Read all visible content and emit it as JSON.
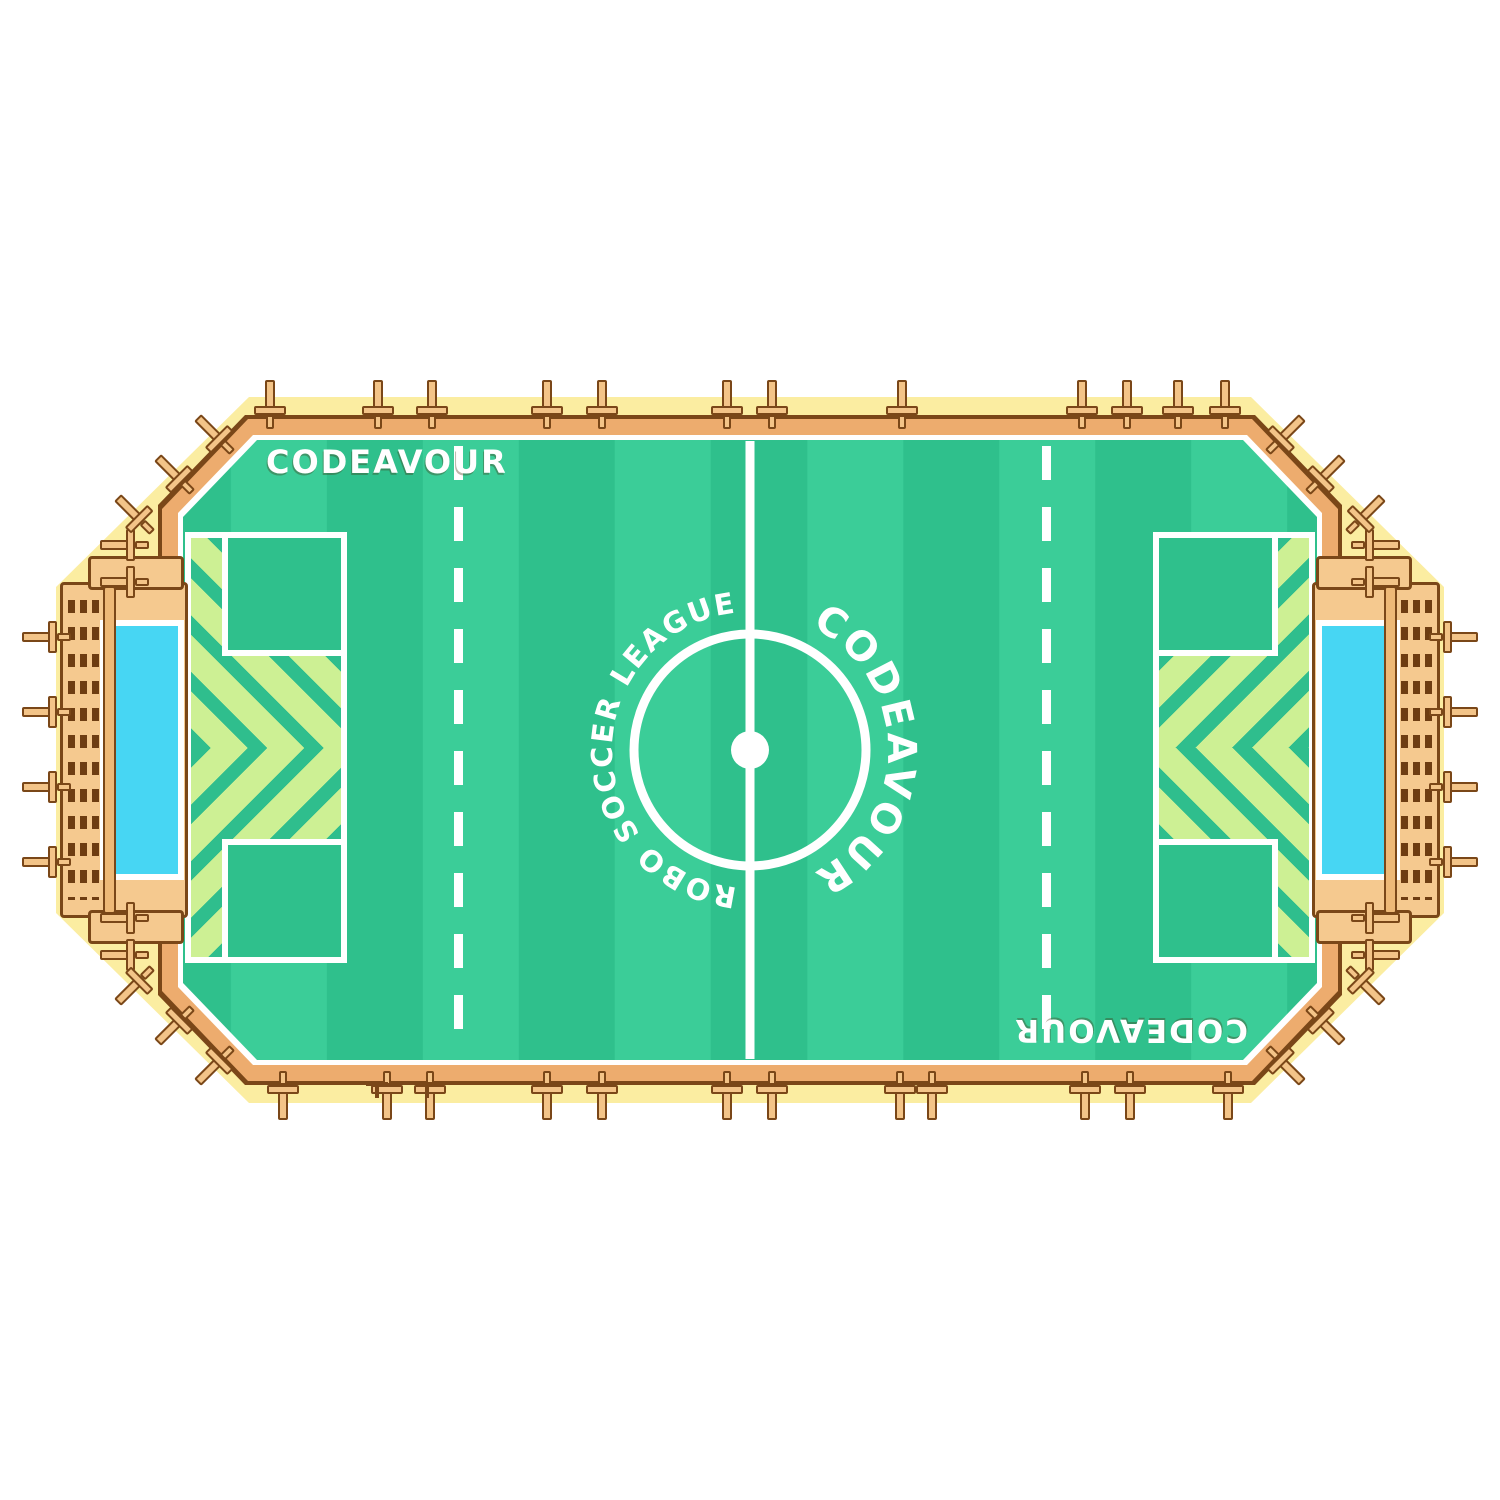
{
  "branding": {
    "top_left_label": "CODEAVOUR",
    "bottom_right_label": "CODEAVOUR",
    "center_circle_left_text": "ROBO SOCCER LEAGUE",
    "center_circle_right_text": "CODEAVOUR"
  },
  "colors": {
    "platform_yellow": "#fbeda1",
    "edge_orange": "#edac6e",
    "outline_brown": "#7a4718",
    "wood_tan": "#f3c488",
    "field_green_dark": "#2fc08c",
    "field_green_light": "#3bcd98",
    "chevron_light": "#cdf094",
    "chevron_stripe": "#2fbe8d",
    "goal_cyan": "#47d6f3",
    "line_white": "#ffffff"
  },
  "clamps": {
    "top_x": [
      270,
      378,
      432,
      547,
      602,
      727,
      772,
      902,
      1082,
      1127,
      1178,
      1225
    ],
    "bottom_x": [
      283,
      387,
      430,
      547,
      602,
      727,
      772,
      900,
      932,
      1085,
      1130,
      1228
    ],
    "left_goal_y": [
      637,
      712,
      787,
      862
    ],
    "right_goal_y": [
      637,
      712,
      787,
      862
    ],
    "wall_left_y": [
      545,
      582,
      918,
      955
    ],
    "wall_right_y": [
      545,
      582,
      918,
      955
    ],
    "diagonal": [
      {
        "x": 216,
        "y": 436,
        "angle": -45
      },
      {
        "x": 176,
        "y": 476,
        "angle": -45
      },
      {
        "x": 136,
        "y": 516,
        "angle": -45
      },
      {
        "x": 1284,
        "y": 436,
        "angle": 45
      },
      {
        "x": 1324,
        "y": 476,
        "angle": 45
      },
      {
        "x": 1364,
        "y": 516,
        "angle": 45
      },
      {
        "x": 216,
        "y": 1064,
        "angle": -135
      },
      {
        "x": 176,
        "y": 1024,
        "angle": -135
      },
      {
        "x": 136,
        "y": 984,
        "angle": -135
      },
      {
        "x": 1284,
        "y": 1064,
        "angle": 135
      },
      {
        "x": 1324,
        "y": 1024,
        "angle": 135
      },
      {
        "x": 1364,
        "y": 984,
        "angle": 135
      }
    ],
    "t_marks": [
      {
        "x": 377,
        "y": 1082
      },
      {
        "x": 427,
        "y": 1082
      }
    ]
  }
}
